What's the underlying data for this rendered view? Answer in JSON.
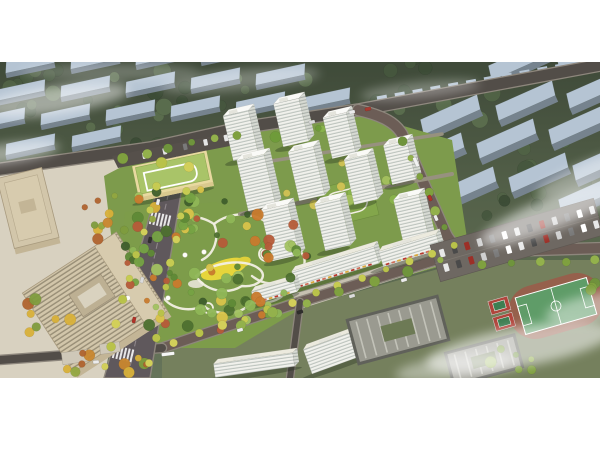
{
  "meta": {
    "type": "aerial-architectural-rendering"
  },
  "frame": {
    "top": 62,
    "height": 316,
    "width": 600
  },
  "palette": {
    "page": "#ffffff",
    "bgTop": "#3f4a39",
    "bgMid": "#55624a",
    "bgLow": "#66745a",
    "ctxTop": "#b5c4d3",
    "ctxFront": "#76838e",
    "roadA": "#524d48",
    "roadB": "#6c5d56",
    "roadEdge": "#8d867c",
    "avenue": "#5f585c",
    "median": "#8f878b",
    "innerPath": "#97917f",
    "pave": "#c6c0b1",
    "paveLight": "#d8d1c0",
    "siteGreen": "#7d9b4c",
    "parkGreen": "#7d9c4a",
    "bottomBase": "#75805d",
    "podium": "#83a64b",
    "path": "#f2efe3",
    "meadow": "#e6d53b",
    "meadow2": "#dfcf3a",
    "plazaRing": "#a55a3e",
    "towerFace": "#f1f1ec",
    "towerSide": "#d7dad3",
    "towerTop": "#fafaf7",
    "officeRoof": "#d2c6aa",
    "officeWall": "#c3b596",
    "officeTrim": "#a89a7e",
    "officeIn": "#d7cbae",
    "schoolWall": "#e8d9a0",
    "schoolRoof": "#a9c468",
    "roofGrey": "#9a9a90",
    "darkWall": "#60615a",
    "skylight": "#c9c9c0",
    "courtGreen": "#6d7a55",
    "track": "#96604c",
    "pitch": "#5f9c68",
    "line": "#ffffff",
    "court": "#b0453c",
    "courtIn": "#3e7e52",
    "lot": "#6e6862",
    "shadow": "rgba(35,45,30,0.35)",
    "fog": "#ffffff",
    "awning": [
      "#b8392e",
      "#cf6f5a",
      "#d9a83c"
    ]
  },
  "palettes": {
    "ctx": [
      "#3c4c36",
      "#46573e",
      "#516346",
      "#5b6e4e"
    ],
    "park": [
      "#4e7030",
      "#5f8a36",
      "#76a344",
      "#8fb757",
      "#a3c262",
      "#c97b2e",
      "#b65b39",
      "#d9c34a",
      "#3f5e2c"
    ],
    "courtyard": [
      "#6f9c3a",
      "#8ab44c",
      "#d2c355",
      "#a4c05e"
    ],
    "plaza": [
      "#c9872f",
      "#d9b13a",
      "#7f9c3e",
      "#b0642f",
      "#93a741"
    ],
    "street": [
      "#c6cb52",
      "#d2cf5a",
      "#b9c24a"
    ],
    "streetGreen": [
      "#7fa03f",
      "#93b14c",
      "#6f943c"
    ]
  },
  "context": {
    "left": {
      "angle": -12,
      "w": 50,
      "top": 11,
      "front": 5,
      "slabs": [
        [
          30,
          6
        ],
        [
          95,
          2
        ],
        [
          160,
          -2
        ],
        [
          225,
          -6
        ],
        [
          20,
          34
        ],
        [
          85,
          30
        ],
        [
          150,
          26
        ],
        [
          215,
          22
        ],
        [
          280,
          18
        ],
        [
          0,
          62
        ],
        [
          65,
          58
        ],
        [
          130,
          54
        ],
        [
          195,
          50
        ],
        [
          260,
          46
        ],
        [
          325,
          42
        ],
        [
          30,
          88
        ],
        [
          96,
          80
        ]
      ]
    },
    "right": {
      "angle": -24,
      "w": 62,
      "top": 15,
      "front": 7,
      "slabs": [
        [
          452,
          60
        ],
        [
          527,
          46
        ],
        [
          598,
          34
        ],
        [
          436,
          98
        ],
        [
          508,
          84
        ],
        [
          580,
          70
        ],
        [
          468,
          132
        ],
        [
          540,
          118
        ],
        [
          604,
          106
        ],
        [
          590,
          140
        ],
        [
          520,
          6
        ],
        [
          588,
          -4
        ]
      ]
    }
  },
  "rowhouses": [
    {
      "from": [
        382,
        42
      ],
      "to": [
        596,
        4
      ],
      "n": 13,
      "w": 10,
      "h": 5
    },
    {
      "from": [
        252,
        72
      ],
      "to": [
        352,
        54
      ],
      "n": 6,
      "w": 9,
      "h": 5
    }
  ],
  "roads": [
    {
      "d": "M -6 108 L 150 86 L 240 66 L 358 48 L 606 2",
      "w": 11,
      "c": "roadA"
    },
    {
      "d": "M 358 48 C 385 54 396 62 402 72 L 446 172 Q 452 184 466 190 L 606 186",
      "w": 10,
      "c": "roadB"
    },
    {
      "d": "M 462 190 L 300 240 L 162 286",
      "w": 9,
      "c": "roadB"
    },
    {
      "d": "M 0 298 L 162 286",
      "w": 8,
      "c": "roadA"
    },
    {
      "d": "M 300 240 L 290 316",
      "w": 6,
      "c": "roadA"
    },
    {
      "d": "M 240 152 L 452 112",
      "w": 4,
      "c": "innerPath",
      "nocase": 1
    },
    {
      "d": "M 252 102 L 442 72",
      "w": 3.5,
      "c": "innerPath",
      "nocase": 1
    }
  ],
  "avenue": {
    "poly": "168,88 188,90 150,316 104,316",
    "median": "M 177 93 L 128 314",
    "crosswalks": [
      [
        161,
        158
      ],
      [
        124,
        292
      ]
    ]
  },
  "bases": {
    "plaza": "0,110 150,88 104,316 0,316",
    "site": "104,114 150,90 240,70 362,52 452,78 470,196 300,244 160,288 118,230",
    "bottom": "162,290 300,246 470,198 606,198 606,316 162,316",
    "park": "125,150 215,140 305,170 312,240 235,286 152,286 118,230",
    "retailPave": "292,232 462,180 472,193 300,247"
  },
  "park": {
    "paths": [
      "M 150 172 C 168 152 196 150 214 162 C 232 148 258 150 270 164 C 288 158 302 172 296 186 C 312 196 304 214 286 218 C 292 234 272 244 252 240 C 242 254 214 254 204 244 C 184 252 164 244 160 228 C 144 222 138 206 150 196 C 138 186 142 176 150 172 Z",
      "M 196 214 C 212 200 244 196 258 206 C 270 214 258 226 242 224 C 226 234 204 228 196 214 Z",
      "M 214 162 C 220 176 214 192 202 198",
      "M 286 218 C 274 224 262 222 252 214"
    ],
    "nodes": [
      [
        150,
        196,
        7
      ],
      [
        266,
        192,
        7
      ],
      [
        208,
        246,
        5
      ],
      [
        294,
        186,
        4
      ]
    ],
    "plaza": [
      266,
      192,
      5
    ],
    "meadow": {
      "c": [
        224,
        207
      ],
      "r": [
        24,
        9
      ],
      "rot": -18
    },
    "meadow2": {
      "c": [
        243,
        200
      ],
      "r": [
        8,
        5
      ],
      "rot": -18
    },
    "hub": {
      "c": [
        196,
        222
      ],
      "r": [
        8,
        4
      ]
    },
    "canopies": [
      [
        185,
        193
      ],
      [
        204,
        190
      ],
      [
        168,
        236
      ],
      [
        128,
        236
      ]
    ]
  },
  "podium": {
    "c": [
      347,
      140
    ],
    "rot": -14,
    "w": 56,
    "h": 40
  },
  "towers": [
    [
      246,
      96,
      26,
      46
    ],
    [
      296,
      82,
      26,
      44
    ],
    [
      344,
      94,
      24,
      42
    ],
    [
      404,
      120,
      24,
      40
    ],
    [
      262,
      146,
      28,
      52
    ],
    [
      312,
      136,
      26,
      50
    ],
    [
      366,
      140,
      24,
      46
    ],
    [
      416,
      178,
      26,
      44
    ],
    [
      286,
      196,
      28,
      52
    ],
    [
      338,
      186,
      26,
      48
    ]
  ],
  "slabs": [
    [
      338,
      214,
      86,
      18,
      -17,
      1
    ],
    [
      412,
      196,
      60,
      16,
      -17,
      1
    ],
    [
      345,
      300,
      70,
      26,
      -20,
      0
    ],
    [
      255,
      310,
      80,
      14,
      -8,
      0
    ],
    [
      276,
      236,
      44,
      13,
      -16,
      1
    ]
  ],
  "school": {
    "c": [
      173,
      114
    ],
    "rot": -12,
    "w": 76,
    "h": 36,
    "parking": "112,94 234,70 240,82 118,106",
    "cars": {
      "from": [
        124,
        98
      ],
      "to": [
        226,
        76
      ],
      "n": 6
    }
  },
  "office": {
    "big": {
      "c": [
        95,
        240
      ],
      "rot": -33,
      "w": 112,
      "h": 94
    },
    "tower": {
      "c": [
        28,
        146
      ],
      "rot": -14,
      "w": 46,
      "h": 72
    }
  },
  "campus": [
    {
      "c": [
        398,
        268
      ],
      "rot": -15,
      "w": 96,
      "h": 48
    },
    {
      "c": [
        484,
        298
      ],
      "rot": -15,
      "w": 74,
      "h": 36
    }
  ],
  "smallbldg": [
    [
      75,
      295,
      26,
      12,
      -8
    ],
    [
      110,
      286,
      20,
      10,
      -8
    ]
  ],
  "sports": {
    "track": {
      "c": [
        556,
        244
      ],
      "rot": -16
    },
    "courts": {
      "c": [
        506,
        252
      ],
      "rot": -16
    }
  },
  "lot": {
    "c": [
      517,
      178
    ],
    "rot": -16,
    "w": 170,
    "h": 38,
    "rows": [
      -8,
      7
    ],
    "n": 13,
    "colors": [
      "#e8e8e8",
      "#4a4a4a",
      "#9c2f27",
      "#cfcfcf",
      "#7a7a7a",
      "#ffffff"
    ]
  },
  "clusters": [
    {
      "c": [
        80,
        28
      ],
      "r": [
        90,
        26
      ],
      "n": 16,
      "p": "ctx",
      "s": 11
    },
    {
      "c": [
        250,
        38
      ],
      "r": [
        95,
        30
      ],
      "n": 15,
      "p": "ctx",
      "s": 12
    },
    {
      "c": [
        170,
        86
      ],
      "r": [
        115,
        26
      ],
      "n": 13,
      "p": "ctx",
      "s": 13
    },
    {
      "c": [
        55,
        112
      ],
      "r": [
        65,
        20
      ],
      "n": 9,
      "p": "ctx",
      "s": 14
    },
    {
      "c": [
        470,
        58
      ],
      "r": [
        95,
        38
      ],
      "n": 14,
      "p": "ctx",
      "s": 15
    },
    {
      "c": [
        545,
        135
      ],
      "r": [
        65,
        30
      ],
      "n": 9,
      "p": "ctx",
      "s": 16
    },
    {
      "c": [
        505,
        225
      ],
      "r": [
        55,
        22
      ],
      "n": 9,
      "p": "ctx",
      "s": 17
    },
    {
      "c": [
        565,
        290
      ],
      "r": [
        45,
        18
      ],
      "n": 7,
      "p": "ctx",
      "s": 18
    },
    {
      "c": [
        25,
        158
      ],
      "r": [
        28,
        16
      ],
      "n": 5,
      "p": "ctx",
      "s": 19
    },
    {
      "c": [
        350,
        8
      ],
      "r": [
        80,
        12
      ],
      "n": 7,
      "p": "ctx",
      "s": 20
    },
    {
      "c": [
        178,
        162
      ],
      "r": [
        42,
        16
      ],
      "n": 12,
      "p": "park",
      "s": 1
    },
    {
      "c": [
        253,
        168
      ],
      "r": [
        42,
        16
      ],
      "n": 12,
      "p": "park",
      "s": 2
    },
    {
      "c": [
        158,
        208
      ],
      "r": [
        28,
        18
      ],
      "n": 10,
      "p": "park",
      "s": 3
    },
    {
      "c": [
        238,
        224
      ],
      "r": [
        48,
        20
      ],
      "n": 14,
      "p": "park",
      "s": 4
    },
    {
      "c": [
        288,
        198
      ],
      "r": [
        22,
        22
      ],
      "n": 9,
      "p": "park",
      "s": 5
    },
    {
      "c": [
        198,
        254
      ],
      "r": [
        52,
        16
      ],
      "n": 14,
      "p": "park",
      "s": 6
    },
    {
      "c": [
        134,
        182
      ],
      "r": [
        16,
        22
      ],
      "n": 7,
      "p": "park",
      "s": 7
    },
    {
      "c": [
        262,
        252
      ],
      "r": [
        30,
        14
      ],
      "n": 8,
      "p": "park",
      "s": 8
    },
    {
      "c": [
        332,
        118
      ],
      "r": [
        68,
        38
      ],
      "n": 16,
      "p": "courtyard",
      "s": 24
    },
    {
      "c": [
        300,
        70
      ],
      "r": [
        40,
        16
      ],
      "n": 8,
      "p": "courtyard",
      "s": 25
    },
    {
      "c": [
        120,
        158
      ],
      "r": [
        48,
        26
      ],
      "n": 12,
      "p": "plaza",
      "s": 21
    },
    {
      "c": [
        88,
        298
      ],
      "r": [
        75,
        13
      ],
      "n": 10,
      "p": "plaza",
      "s": 22
    },
    {
      "c": [
        55,
        255
      ],
      "r": [
        30,
        18
      ],
      "n": 7,
      "p": "plaza",
      "s": 23
    },
    {
      "c": [
        180,
        134
      ],
      "r": [
        45,
        10
      ],
      "n": 8,
      "p": "park",
      "s": 26
    },
    {
      "c": [
        520,
        300
      ],
      "r": [
        40,
        14
      ],
      "n": 6,
      "p": "streetGreen",
      "s": 27
    },
    {
      "c": [
        597,
        225
      ],
      "r": [
        20,
        12
      ],
      "n": 4,
      "p": "streetGreen",
      "s": 28
    }
  ],
  "streetTrees": [
    {
      "a": [
        163,
        102
      ],
      "b": [
        104,
        306
      ],
      "n": 10,
      "p": "street"
    },
    {
      "a": [
        190,
        104
      ],
      "b": [
        150,
        300
      ],
      "n": 9,
      "p": "street"
    },
    {
      "a": [
        455,
        184
      ],
      "b": [
        175,
        280
      ],
      "n": 13,
      "p": "street"
    },
    {
      "a": [
        440,
        198
      ],
      "b": [
        240,
        262
      ],
      "n": 7,
      "p": "streetGreen"
    },
    {
      "a": [
        404,
        78
      ],
      "b": [
        444,
        166
      ],
      "n": 6,
      "p": "streetGreen"
    },
    {
      "a": [
        124,
        96
      ],
      "b": [
        236,
        72
      ],
      "n": 6,
      "p": "streetGreen"
    },
    {
      "a": [
        482,
        204
      ],
      "b": [
        596,
        198
      ],
      "n": 5,
      "p": "streetGreen"
    }
  ],
  "cars": [
    [
      352,
      50,
      -12,
      "#ececec",
      6
    ],
    [
      368,
      47,
      -12,
      "#a83a30",
      6
    ],
    [
      312,
      60,
      -12,
      "#dcdcdc",
      6
    ],
    [
      416,
      100,
      66,
      "#f2f2f2",
      10
    ],
    [
      430,
      136,
      66,
      "#b03228",
      6
    ],
    [
      436,
      156,
      66,
      "#ececec",
      6
    ],
    [
      158,
      140,
      -77,
      "#ececec",
      6
    ],
    [
      150,
      178,
      -77,
      "#30302e",
      6
    ],
    [
      142,
      218,
      -77,
      "#dcdcdc",
      6
    ],
    [
      134,
      258,
      -77,
      "#b03228",
      6
    ],
    [
      168,
      292,
      -7,
      "#f6f6f6",
      13
    ],
    [
      240,
      268,
      -17,
      "#ececec",
      6
    ],
    [
      300,
      250,
      -17,
      "#2e2e2c",
      6
    ],
    [
      352,
      234,
      -17,
      "#dcdcdc",
      6
    ],
    [
      404,
      218,
      -17,
      "#ececec",
      6
    ],
    [
      96,
      300,
      -4,
      "#ececec",
      6
    ]
  ],
  "fog": [
    [
      55,
      38,
      75,
      14,
      -8,
      0.5
    ],
    [
      5,
      92,
      55,
      10,
      -8,
      0.45
    ],
    [
      240,
      18,
      80,
      10,
      -5,
      0.3
    ],
    [
      420,
      28,
      60,
      8,
      -6,
      0.3
    ],
    [
      555,
      150,
      80,
      16,
      -22,
      0.55
    ],
    [
      588,
      112,
      55,
      12,
      -22,
      0.4
    ],
    [
      520,
      285,
      95,
      20,
      -10,
      0.55
    ],
    [
      600,
      245,
      55,
      14,
      -10,
      0.45
    ],
    [
      455,
      305,
      60,
      12,
      -8,
      0.4
    ],
    [
      110,
      10,
      90,
      8,
      0,
      0.25
    ]
  ]
}
